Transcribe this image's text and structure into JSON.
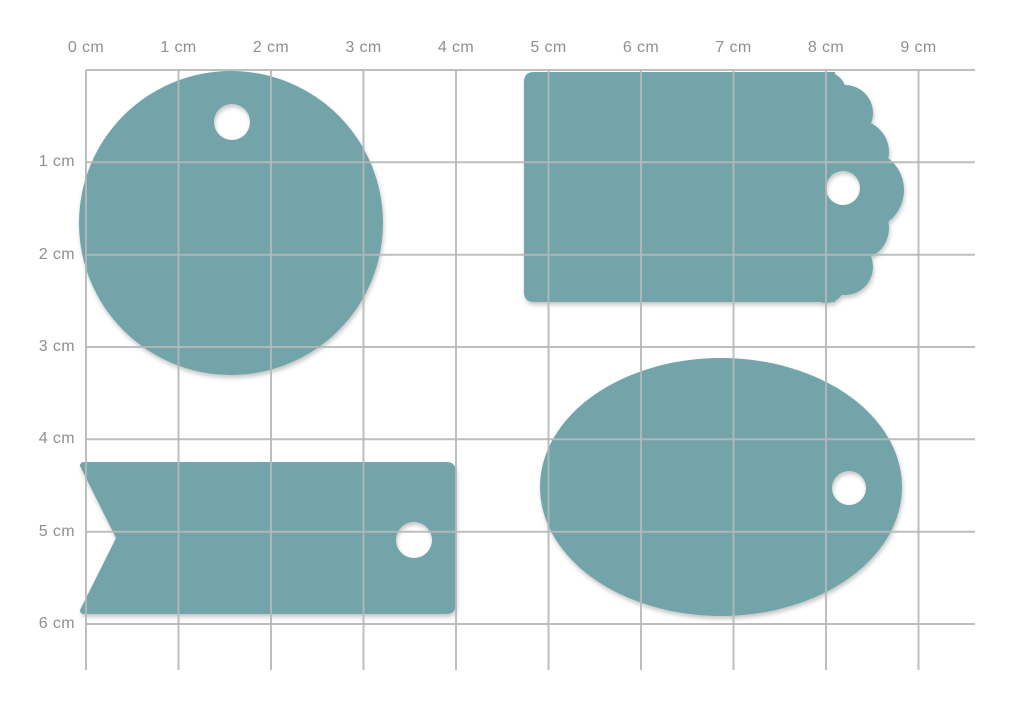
{
  "colors": {
    "tag_fill": "#73A4A9",
    "hole_fill": "#FFFFFF",
    "grid_line": "#B5B8B8",
    "label_text": "#8D9090",
    "background": "#FFFFFF"
  },
  "ruler": {
    "unit": "cm",
    "cell_size_cm": 1,
    "top_labels": [
      "0 cm",
      "1 cm",
      "2 cm",
      "3 cm",
      "4 cm",
      "5 cm",
      "6 cm",
      "7 cm",
      "8 cm",
      "9 cm"
    ],
    "side_labels": [
      "1 cm",
      "2 cm",
      "3 cm",
      "4 cm",
      "5 cm",
      "6 cm"
    ]
  },
  "shapes": [
    {
      "id": "round-tag",
      "form": "circle-with-hole",
      "approx_width_cm": 3.3,
      "approx_height_cm": 3.3,
      "hole_diameter_cm": 0.4
    },
    {
      "id": "scalloped-tag",
      "form": "rectangle-with-scalloped-right-edge",
      "approx_width_cm": 4.1,
      "approx_height_cm": 2.5,
      "hole_diameter_cm": 0.37
    },
    {
      "id": "flag-tag",
      "form": "banner-with-notched-left-end",
      "approx_width_cm": 4.1,
      "approx_height_cm": 1.6,
      "hole_diameter_cm": 0.4
    },
    {
      "id": "oval-tag",
      "form": "ellipse-with-hole",
      "approx_width_cm": 3.9,
      "approx_height_cm": 2.8,
      "hole_diameter_cm": 0.37
    }
  ]
}
